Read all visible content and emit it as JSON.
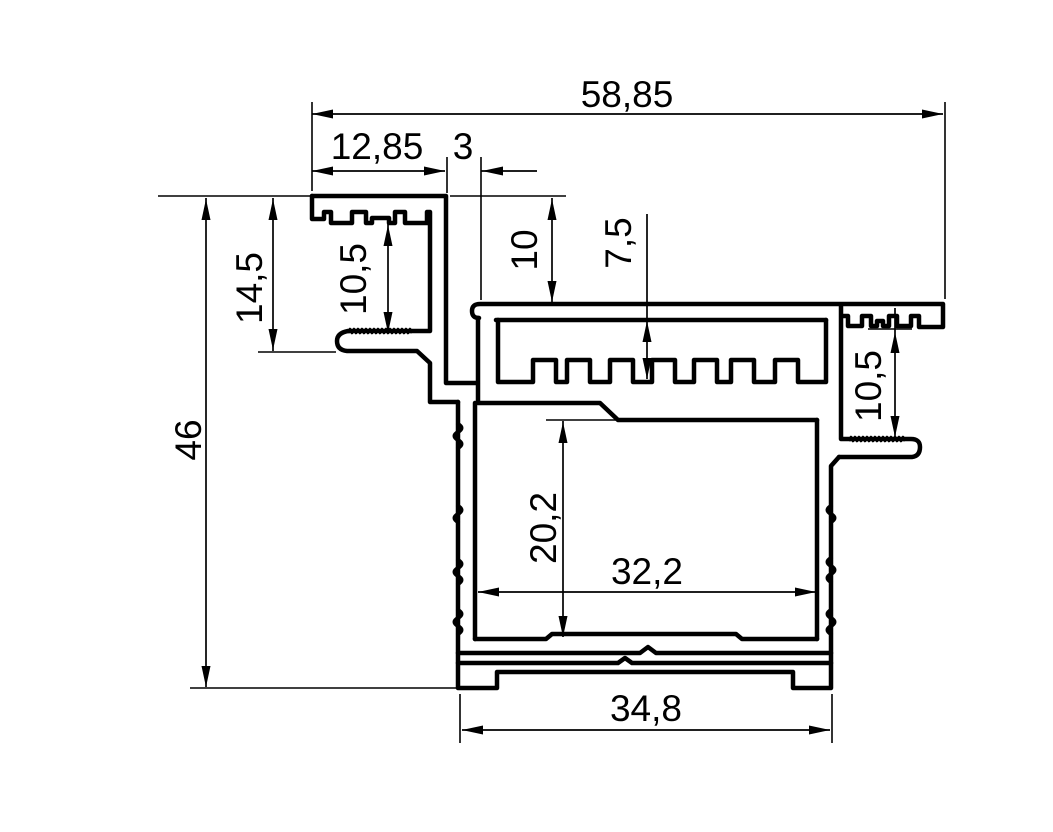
{
  "drawing": {
    "type": "technical-profile-cross-section",
    "background_color": "#ffffff",
    "line_color": "#000000",
    "dimensions": {
      "overall_width": {
        "label": "58,85"
      },
      "flange_width": {
        "label": "12,85"
      },
      "slot_gap": {
        "label": "3"
      },
      "top_step_depth": {
        "label": "10"
      },
      "comb_channel_depth": {
        "label": "7,5"
      },
      "left_channel_opening": {
        "label": "10,5"
      },
      "left_flange_height": {
        "label": "14,5"
      },
      "overall_height": {
        "label": "46"
      },
      "right_channel_opening": {
        "label": "10,5"
      },
      "cavity_height": {
        "label": "20,2"
      },
      "cavity_width": {
        "label": "32,2"
      },
      "base_width": {
        "label": "34,8"
      }
    }
  }
}
